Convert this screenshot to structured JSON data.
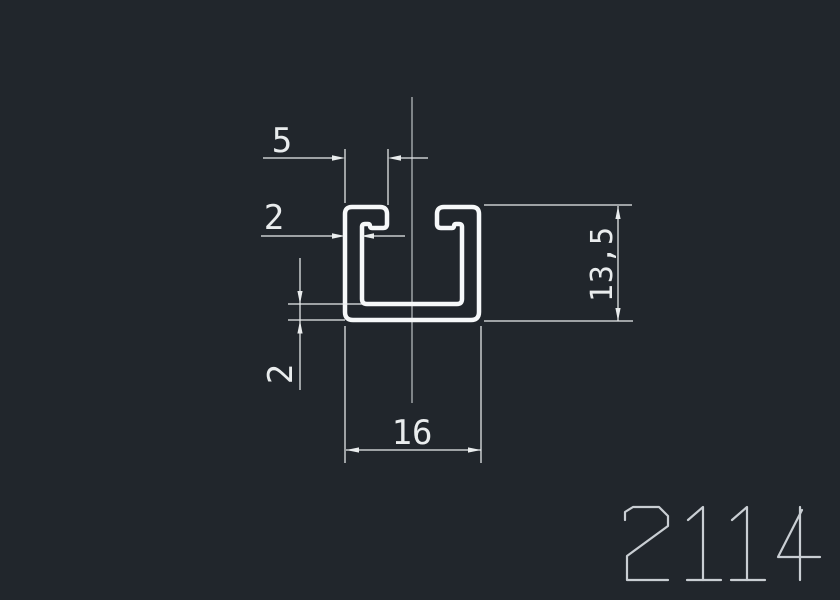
{
  "drawing": {
    "part_number": "2114",
    "view": "c-channel-profile-cross-section",
    "dim_labels": {
      "lip_width": "5",
      "wall_thickness": "2",
      "base_thickness": "2",
      "width": "16",
      "height": "13,5"
    }
  },
  "colors": {
    "background": "#21262c",
    "profile_line": "#f6f8f9",
    "dimension_line": "#e9eced",
    "annotation_text": "#c9ced3"
  }
}
